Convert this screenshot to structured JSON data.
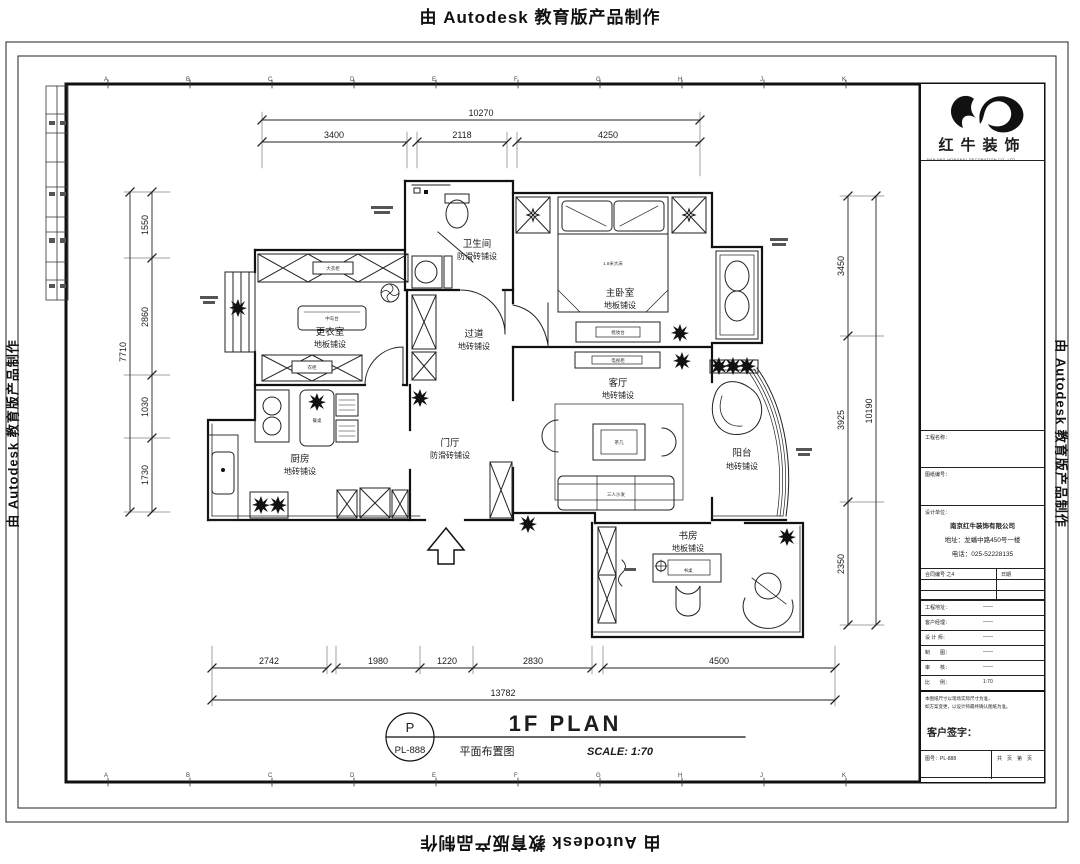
{
  "banner": {
    "text": "由 Autodesk 教育版产品制作"
  },
  "grid_letters": [
    "A",
    "B",
    "C",
    "D",
    "E",
    "F",
    "G",
    "H",
    "J",
    "K"
  ],
  "dims": {
    "top": {
      "total": "10270",
      "segments": [
        "3400",
        "2118",
        "4250"
      ]
    },
    "left": {
      "total": "7710",
      "segments": [
        "1550",
        "2860",
        "1030",
        "1730"
      ]
    },
    "right": {
      "total": "10190",
      "segments": [
        "3450",
        "3925",
        "2350"
      ]
    },
    "bottom": {
      "total": "13782",
      "segments": [
        "2742",
        "1980",
        "1220",
        "2830",
        "4500"
      ]
    }
  },
  "plan": {
    "rooms": [
      {
        "name": "更衣室",
        "finish": "地板铺设"
      },
      {
        "name": "卫生间",
        "finish": "防滑砖铺设"
      },
      {
        "name": "主卧室",
        "finish": "地板铺设"
      },
      {
        "name": "过道",
        "finish": "地砖铺设"
      },
      {
        "name": "客厅",
        "finish": "地砖铺设"
      },
      {
        "name": "厨房",
        "finish": "地砖铺设"
      },
      {
        "name": "门厅",
        "finish": "防滑砖铺设"
      },
      {
        "name": "阳台",
        "finish": "地砖铺设"
      },
      {
        "name": "书房",
        "finish": "地板铺设"
      }
    ],
    "furniture": {
      "bed": "1.8米大床",
      "dresser": "梳妆台",
      "tv": "电视柜",
      "coffee": "茶几",
      "sofa": "三人沙发",
      "island": "中岛台",
      "dining": "餐桌",
      "desk": "书桌",
      "wardrobe_top": "大衣柜",
      "wardrobe_bottom": "衣柜"
    }
  },
  "footer_title": {
    "bubble_top": "P",
    "bubble_bottom": "PL-888",
    "big": "1F PLAN",
    "cn": "平面布置图",
    "scale": "SCALE: 1:70"
  },
  "titleblock": {
    "brand": "红牛装饰",
    "brand_sub": "NANJING HONGNIU DECORATION CO.,LTD",
    "section1": "工程名称：",
    "section2": "图纸编号：",
    "section3": "设计单位：",
    "company": {
      "name": "南京红牛装饰有限公司",
      "address": "地址：龙蟠中路450号一楼",
      "phone": "电话：025-52228135"
    },
    "table": {
      "c1": "合同编号 之4",
      "c2": "日期"
    },
    "rows": [
      {
        "label": "工程地址：",
        "value": "——"
      },
      {
        "label": "客户经理：",
        "value": "——"
      },
      {
        "label": "设 计 师：",
        "value": "——"
      },
      {
        "label": "制　　图：",
        "value": "——"
      },
      {
        "label": "审　　核：",
        "value": "——"
      },
      {
        "label": "比　　例：",
        "value": "1:70"
      }
    ],
    "notes": [
      "本图纸尺寸以现场实际尺寸为准，",
      "如方案变更，以设计师最终确认图纸为准。"
    ],
    "sign_label": "客户签字：",
    "footer": {
      "left": "图号：PL-888",
      "right": "共　页　第　页"
    }
  },
  "colors": {
    "ink": "#1c1c1c"
  }
}
